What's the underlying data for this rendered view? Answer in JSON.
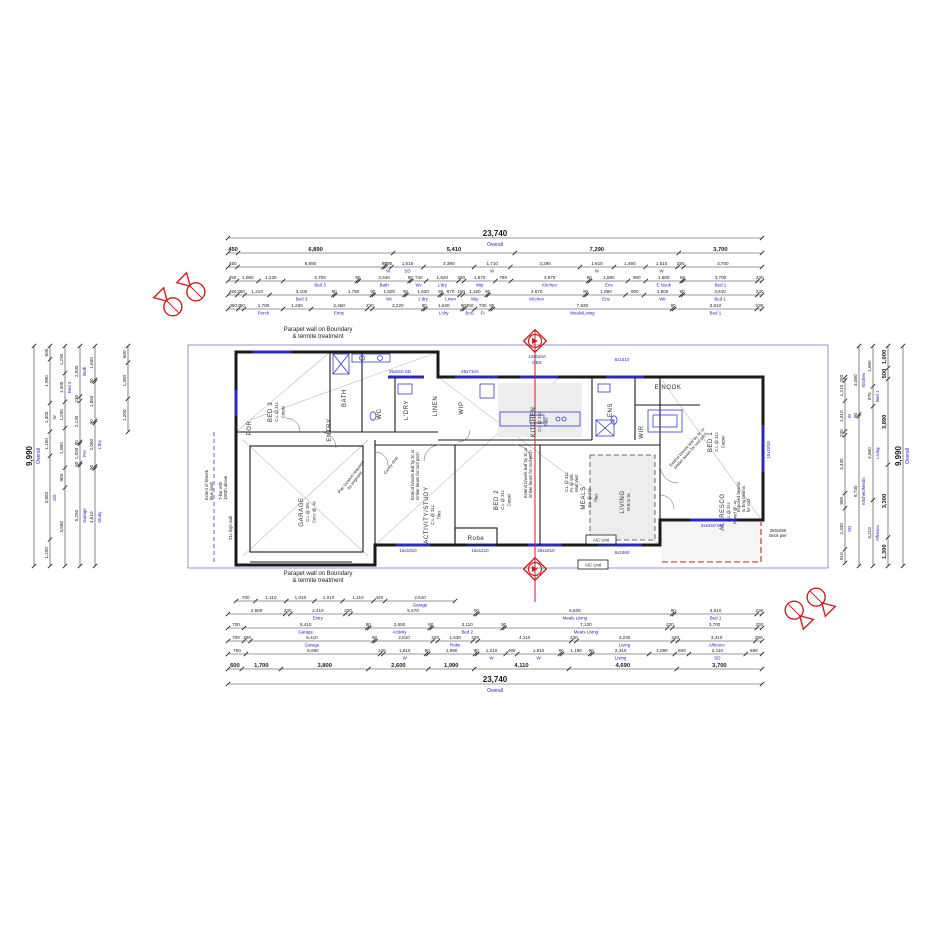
{
  "colors": {
    "wall": "#1a1a1a",
    "annotation_blue": "#2a2ac0",
    "dim_label_blue": "#2222bb",
    "section_red": "#c92222",
    "room_fill_gray": "#ededed"
  },
  "labels": {
    "ac_unit": "A/C Unit",
    "overall": "Overall"
  },
  "notes": [
    {
      "lines": [
        "Parapet wall on Boundary",
        "& termite treatment"
      ],
      "x": 318,
      "y": 331,
      "rot": 0,
      "size": 6,
      "anchor": "middle"
    },
    {
      "lines": [
        "Parapet wall on Boundary",
        "& termite treatment"
      ],
      "x": 318,
      "y": 575,
      "rot": 0,
      "size": 6,
      "anchor": "middle"
    },
    {
      "lines": [
        "Extend b/work leaf by 3c or",
        "timber beam for roof pitch"
      ],
      "x": 414,
      "y": 500,
      "rot": -90,
      "size": 4.2,
      "anchor": "start"
    },
    {
      "lines": [
        "Extend b/work leaf by 3c or",
        "timber beam for roof pitch"
      ],
      "x": 527,
      "y": 498,
      "rot": -90,
      "size": 4.2,
      "anchor": "start"
    },
    {
      "lines": [
        "Extend b/work leaf by 3c or",
        "timber beam for roof pitch"
      ],
      "x": 688,
      "y": 448,
      "rot": -48,
      "size": 4.2,
      "anchor": "middle"
    },
    {
      "lines": [
        "Exposed beams",
        "to Eng beams",
        "for roof"
      ],
      "x": 740,
      "y": 512,
      "rot": -90,
      "size": 4.2,
      "anchor": "start"
    },
    {
      "lines": [
        "260x290",
        "Brick pier"
      ],
      "x": 778,
      "y": 532,
      "rot": 0,
      "size": 4.2,
      "anchor": "middle"
    },
    {
      "lines": [
        "Pier location required",
        "by engineer"
      ],
      "x": 352,
      "y": 478,
      "rot": -52,
      "size": 4.2,
      "anchor": "middle"
    },
    {
      "lines": [
        "Cavity door"
      ],
      "x": 392,
      "y": 466,
      "rot": -52,
      "size": 4.2,
      "anchor": "middle"
    },
    {
      "lines": [
        "C.L @ 31c",
        "FL @ 60c",
        "Wall Vent"
      ],
      "x": 568,
      "y": 492,
      "rot": -90,
      "size": 4.2,
      "anchor": "start"
    },
    {
      "lines": [
        "Extent of b/work",
        "blue dash"
      ],
      "x": 208,
      "y": 500,
      "rot": -90,
      "size": 4.2,
      "anchor": "start"
    },
    {
      "lines": [
        "T-bar with",
        "1900h above"
      ],
      "x": 222,
      "y": 500,
      "rot": -90,
      "size": 4.2,
      "anchor": "start"
    },
    {
      "lines": [
        "21c high wall"
      ],
      "x": 232,
      "y": 540,
      "rot": -90,
      "size": 4.2,
      "anchor": "start"
    }
  ],
  "rooms": [
    {
      "label": "BED 3",
      "sub": [
        "C.L @ 31c",
        "Carpet"
      ],
      "x": 272,
      "y": 412,
      "rot": -90
    },
    {
      "label": "BATH",
      "sub": [],
      "x": 346,
      "y": 398,
      "rot": -90
    },
    {
      "label": "WC",
      "sub": [],
      "x": 381,
      "y": 414,
      "rot": -90
    },
    {
      "label": "L'DRY",
      "sub": [],
      "x": 408,
      "y": 410,
      "rot": -90
    },
    {
      "label": "LINEN",
      "sub": [],
      "x": 437,
      "y": 406,
      "rot": -90
    },
    {
      "label": "WIP",
      "sub": [],
      "x": 463,
      "y": 408,
      "rot": -90
    },
    {
      "label": "KITCHEN",
      "sub": [
        "C.L @ 31c",
        "Tiles"
      ],
      "x": 535,
      "y": 422,
      "rot": -90
    },
    {
      "label": "ENS",
      "sub": [],
      "x": 612,
      "y": 410,
      "rot": -90
    },
    {
      "label": "E NOOK",
      "sub": [],
      "x": 668,
      "y": 389,
      "rot": 0
    },
    {
      "label": "WIR",
      "sub": [],
      "x": 643,
      "y": 432,
      "rot": -90
    },
    {
      "label": "BED 1",
      "sub": [
        "C.L @ 31c",
        "Carpet"
      ],
      "x": 712,
      "y": 442,
      "rot": -90
    },
    {
      "label": "POR",
      "sub": [],
      "x": 251,
      "y": 428,
      "rot": -90
    },
    {
      "label": "ENTRY",
      "sub": [],
      "x": 331,
      "y": 430,
      "rot": -90
    },
    {
      "label": "GARAGE",
      "sub": [
        "C.L @ 28c",
        "Conc @ -4c"
      ],
      "x": 303,
      "y": 512,
      "rot": -90
    },
    {
      "label": "ACTIVITY/STUDY",
      "sub": [
        "C.L @ 31c",
        "Tiles"
      ],
      "x": 428,
      "y": 515,
      "rot": -90
    },
    {
      "label": "BED 2",
      "sub": [
        "C.L @ 31c",
        "Carpet"
      ],
      "x": 498,
      "y": 500,
      "rot": -90
    },
    {
      "label": "Robe",
      "sub": [],
      "x": 476,
      "y": 540,
      "rot": 0
    },
    {
      "label": "MEALS",
      "sub": [
        "C.L @ 31c",
        "Tiles"
      ],
      "x": 585,
      "y": 498,
      "rot": -90
    },
    {
      "label": "LIVING",
      "sub": [
        "W.B to 9c"
      ],
      "x": 624,
      "y": 502,
      "rot": -90
    },
    {
      "label": "ALFRESCO",
      "sub": [
        "C.L @ 31c",
        "Paved @ -4c"
      ],
      "x": 724,
      "y": 512,
      "rot": -90
    }
  ],
  "windows": [
    {
      "t": "25x610 SD",
      "x": 400,
      "y": 373,
      "rot": 0
    },
    {
      "t": "25x710A",
      "x": 470,
      "y": 373,
      "rot": 0
    },
    {
      "t": "13x610A",
      "x": 537,
      "y": 358,
      "rot": 0
    },
    {
      "t": "OBS",
      "x": 537,
      "y": 364,
      "rot": 0
    },
    {
      "t": "6x1510",
      "x": 622,
      "y": 361,
      "rot": 0
    },
    {
      "t": "15x1810",
      "x": 770,
      "y": 450,
      "rot": -90
    },
    {
      "t": "2x2410 SD",
      "x": 712,
      "y": 527,
      "rot": 0
    },
    {
      "t": "16x1810",
      "x": 408,
      "y": 552,
      "rot": 0
    },
    {
      "t": "16x1210",
      "x": 480,
      "y": 552,
      "rot": 0
    },
    {
      "t": "25x1810",
      "x": 546,
      "y": 552,
      "rot": 0
    },
    {
      "t": "6x2460",
      "x": 622,
      "y": 554,
      "rot": 0
    }
  ],
  "ac_units": [
    {
      "x": 586,
      "y": 535
    },
    {
      "x": 578,
      "y": 560
    }
  ],
  "dims": {
    "top": [
      {
        "y": 238,
        "x1": 228,
        "x2": 762,
        "big": true,
        "segs": [
          [
            23740,
            "Overall"
          ]
        ]
      },
      {
        "y": 253,
        "x1": 228,
        "x2": 762,
        "md": true,
        "segs": [
          [
            450
          ],
          [
            6890
          ],
          [
            5410
          ],
          [
            7290
          ],
          [
            3700
          ]
        ]
      },
      {
        "y": 267,
        "x1": 228,
        "x2": 762,
        "segs": [
          [
            450
          ],
          [
            6890
          ],
          [
            90
          ],
          [
            290,
            "W"
          ],
          [
            1515,
            "SD"
          ],
          [
            2390
          ],
          [
            1710,
            "W"
          ],
          [
            3290
          ],
          [
            1610,
            "W"
          ],
          [
            1490
          ],
          [
            1510,
            "W"
          ],
          [
            290
          ],
          [
            3700
          ]
        ]
      },
      {
        "y": 281,
        "x1": 228,
        "x2": 762,
        "segs": [
          [
            450
          ],
          [
            1080
          ],
          [
            1230
          ],
          [
            3700,
            "Bed 3"
          ],
          [
            90
          ],
          [
            2540,
            "Bath"
          ],
          [
            90
          ],
          [
            740,
            "Wc"
          ],
          [
            1620,
            "L'dry"
          ],
          [
            280
          ],
          [
            1570,
            "Wip"
          ],
          [
            780
          ],
          [
            3870,
            "Kitchen"
          ],
          [
            90
          ],
          [
            1890,
            "Ens"
          ],
          [
            900
          ],
          [
            1800,
            "E Nook"
          ],
          [
            90
          ],
          [
            3700,
            "Bed 1"
          ],
          [
            230
          ]
        ]
      },
      {
        "y": 295,
        "x1": 228,
        "x2": 762,
        "segs": [
          [
            450
          ],
          [
            360
          ],
          [
            1210
          ],
          [
            3100,
            "Bed 3"
          ],
          [
            90
          ],
          [
            1780
          ],
          [
            90
          ],
          [
            1500,
            "Wc"
          ],
          [
            90
          ],
          [
            1620,
            "L'dry"
          ],
          [
            90
          ],
          [
            870,
            "Linen"
          ],
          [
            160
          ],
          [
            1160,
            "Wip"
          ],
          [
            90
          ],
          [
            4670,
            "Kitchen"
          ],
          [
            90
          ],
          [
            1890,
            "Ens"
          ],
          [
            900
          ],
          [
            1800,
            "Wir"
          ],
          [
            90
          ],
          [
            3610,
            "Bed 1"
          ],
          [
            230
          ]
        ]
      },
      {
        "y": 309,
        "x1": 228,
        "x2": 762,
        "segs": [
          [
            450
          ],
          [
            250
          ],
          [
            1700,
            "Porch"
          ],
          [
            1230
          ],
          [
            2450,
            "Entry"
          ],
          [
            230
          ],
          [
            2220
          ],
          [
            90
          ],
          [
            1620,
            "L'dry"
          ],
          [
            90
          ],
          [
            450,
            "BnS"
          ],
          [
            700,
            "Fr"
          ],
          [
            90
          ],
          [
            7830,
            "Meals/Living"
          ],
          [
            90
          ],
          [
            3610,
            "Bed 1"
          ],
          [
            230
          ]
        ]
      }
    ],
    "bottom": [
      {
        "y": 601,
        "x1": 236,
        "x2": 455,
        "segs": [
          [
            700
          ],
          [
            1110
          ],
          [
            1010
          ],
          [
            1010
          ],
          [
            1110
          ],
          [
            420
          ],
          [
            2510,
            "Garage"
          ]
        ]
      },
      {
        "y": 614,
        "x1": 228,
        "x2": 762,
        "segs": [
          [
            2500
          ],
          [
            230
          ],
          [
            2410,
            "Entry"
          ],
          [
            230
          ],
          [
            5470
          ],
          [
            90
          ],
          [
            8530,
            "Meals Living"
          ],
          [
            90
          ],
          [
            3610,
            "Bed 1"
          ],
          [
            230
          ]
        ]
      },
      {
        "y": 628,
        "x1": 228,
        "x2": 762,
        "segs": [
          [
            700
          ],
          [
            5410,
            "Garage"
          ],
          [
            90
          ],
          [
            2650,
            "Activity"
          ],
          [
            90
          ],
          [
            3110,
            "Bed 2"
          ],
          [
            90
          ],
          [
            7130,
            "Meals Living"
          ],
          [
            230
          ],
          [
            3700
          ],
          [
            230
          ]
        ]
      },
      {
        "y": 641,
        "x1": 228,
        "x2": 762,
        "segs": [
          [
            700
          ],
          [
            290
          ],
          [
            5410,
            "Garage"
          ],
          [
            90
          ],
          [
            2510
          ],
          [
            230
          ],
          [
            1530,
            "Robe"
          ],
          [
            230
          ],
          [
            4110
          ],
          [
            230
          ],
          [
            4230,
            "Living"
          ],
          [
            230
          ],
          [
            3410,
            "Alfresco"
          ],
          [
            290
          ]
        ]
      },
      {
        "y": 654,
        "x1": 228,
        "x2": 762,
        "segs": [
          [
            760
          ],
          [
            5690
          ],
          [
            140
          ],
          [
            1810,
            "W"
          ],
          [
            90
          ],
          [
            1990
          ],
          [
            90
          ],
          [
            1210,
            "W"
          ],
          [
            490
          ],
          [
            1810,
            "W"
          ],
          [
            90
          ],
          [
            1190
          ],
          [
            90
          ],
          [
            2410,
            "Living"
          ],
          [
            1090
          ],
          [
            600
          ],
          [
            2410,
            "SD"
          ],
          [
            690
          ]
        ]
      },
      {
        "y": 669,
        "x1": 228,
        "x2": 762,
        "md": true,
        "segs": [
          [
            600
          ],
          [
            1700
          ],
          [
            3800
          ],
          [
            2600
          ],
          [
            1990
          ],
          [
            4110
          ],
          [
            4690
          ],
          [
            3700
          ]
        ]
      },
      {
        "y": 684,
        "x1": 228,
        "x2": 762,
        "big": true,
        "segs": [
          [
            23740,
            "Overall"
          ]
        ]
      }
    ],
    "left": [
      {
        "x": 34,
        "y1": 346,
        "y2": 566,
        "big": true,
        "segs": [
          [
            9990,
            "Overall"
          ]
        ]
      },
      {
        "x": 50,
        "y1": 346,
        "y2": 566,
        "segs": [
          [
            600
          ],
          [
            1990
          ],
          [
            1300,
            "W"
          ],
          [
            1100
          ],
          [
            3800,
            "GD"
          ],
          [
            1200
          ]
        ]
      },
      {
        "x": 65,
        "y1": 346,
        "y2": 566,
        "segs": [
          [
            1230
          ],
          [
            1300,
            "Bed 3"
          ],
          [
            1200
          ],
          [
            1800
          ],
          [
            900
          ],
          [
            3560
          ]
        ]
      },
      {
        "x": 80,
        "y1": 346,
        "y2": 566,
        "segs": [
          [
            2630,
            "Bath"
          ],
          [
            230
          ],
          [
            2130
          ],
          [
            90
          ],
          [
            1030,
            "Por"
          ],
          [
            90
          ],
          [
            5250,
            "Garage"
          ]
        ]
      },
      {
        "x": 95,
        "y1": 346,
        "y2": 566,
        "segs": [
          [
            1600
          ],
          [
            90
          ],
          [
            1850
          ],
          [
            90
          ],
          [
            2060,
            "L'dry"
          ],
          [
            90
          ],
          [
            4610,
            "Study"
          ]
        ]
      },
      {
        "x": 128,
        "y1": 346,
        "y2": 432,
        "segs": [
          [
            600
          ],
          [
            1300
          ],
          [
            1200
          ]
        ]
      }
    ],
    "right": [
      {
        "x": 845,
        "y1": 377,
        "y2": 563,
        "segs": [
          [
            200
          ],
          [
            1210
          ],
          [
            1810,
            "W"
          ],
          [
            230
          ],
          [
            3430
          ],
          [
            900
          ],
          [
            2430,
            "SD"
          ],
          [
            810
          ]
        ]
      },
      {
        "x": 859,
        "y1": 346,
        "y2": 566,
        "segs": [
          [
            3080,
            "Kitchen"
          ],
          [
            90
          ],
          [
            6730,
            "Kitchen/Meals"
          ]
        ]
      },
      {
        "x": 873,
        "y1": 346,
        "y2": 566,
        "segs": [
          [
            1960
          ],
          [
            970,
            "Bed 1"
          ],
          [
            4560,
            "Living"
          ],
          [
            3210,
            "Alfresco"
          ]
        ]
      },
      {
        "x": 888,
        "y1": 346,
        "y2": 566,
        "md": true,
        "segs": [
          [
            1000
          ],
          [
            500
          ],
          [
            3890
          ],
          [
            3300
          ],
          [
            1300
          ]
        ]
      },
      {
        "x": 903,
        "y1": 346,
        "y2": 566,
        "big": true,
        "segs": [
          [
            9990,
            "Overall"
          ]
        ]
      }
    ]
  }
}
